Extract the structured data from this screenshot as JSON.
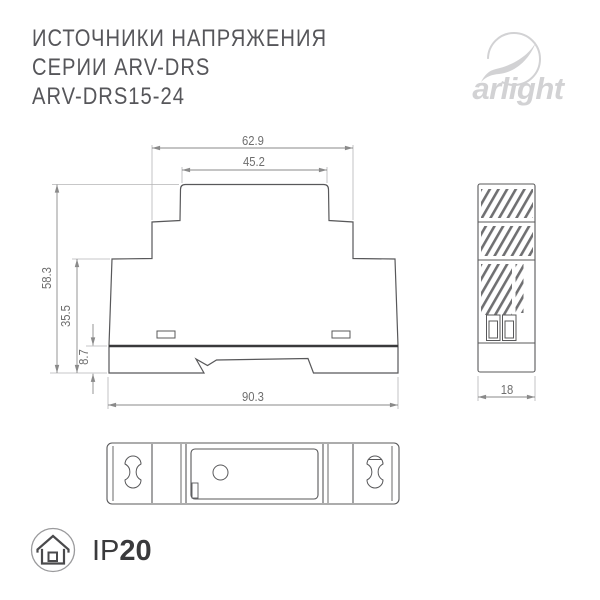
{
  "header": {
    "title_line1": "ИСТОЧНИКИ НАПРЯЖЕНИЯ",
    "title_line2": "СЕРИИ ARV-DRS",
    "title_line3": "ARV-DRS15-24",
    "brand": "arlight"
  },
  "drawing": {
    "front_view": {
      "dim_top_outer_width": "62.9",
      "dim_top_inner_width": "45.2",
      "dim_total_height": "58.3",
      "dim_body_height": "35.5",
      "dim_rail_height": "8.7",
      "dim_total_width": "90.3"
    },
    "side_view": {
      "dim_depth": "18"
    }
  },
  "footer": {
    "ip_prefix": "IP",
    "ip_value": "20"
  },
  "colors": {
    "outline": "#58585a",
    "dimension_line": "#8a8a8a",
    "extension_line": "#b4b4b6",
    "dark_rail_line": "#39393b",
    "brand_gray": "#d2d2d4",
    "text_dark": "#3a3a3c"
  }
}
